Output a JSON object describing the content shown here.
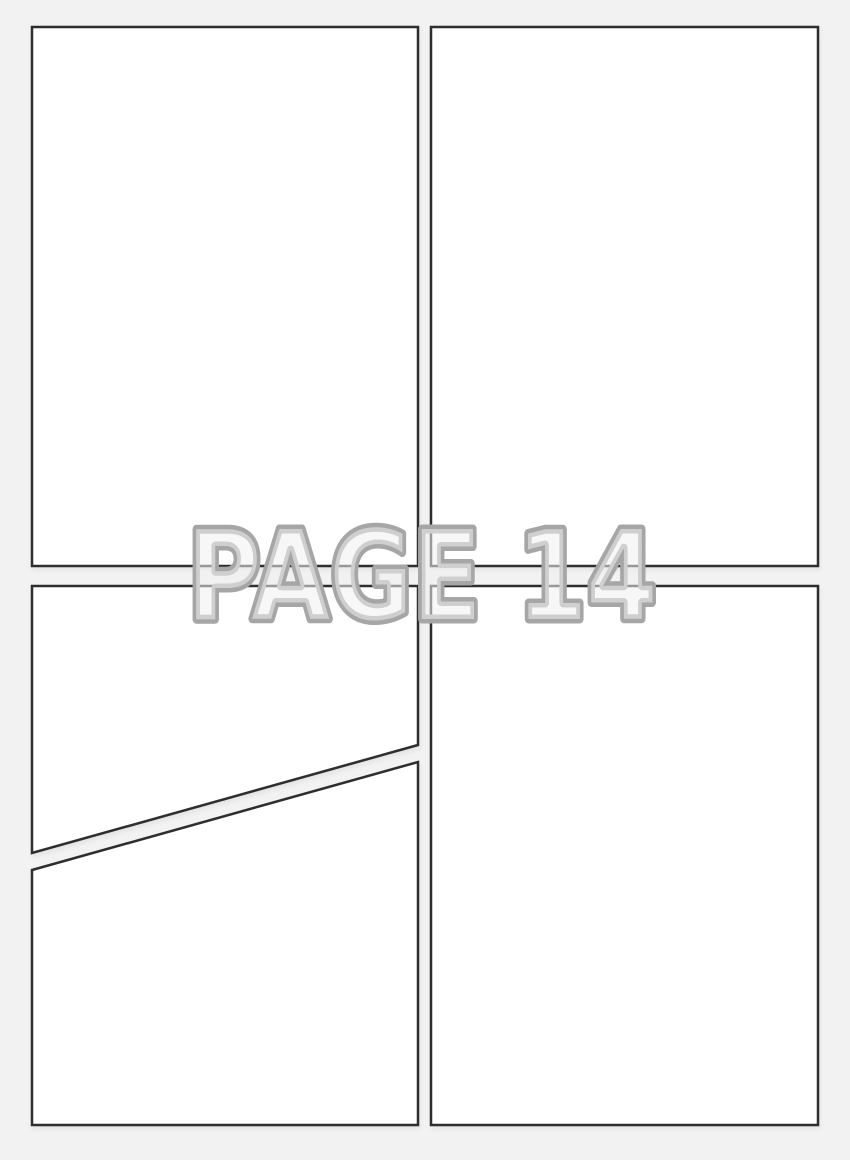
{
  "page": {
    "watermark_text": "PAGE 14",
    "page_number": "14",
    "kind": "blank-comic-page-template"
  },
  "panels": [
    {
      "name": "panel-top-left",
      "position": "top-left",
      "shape": "rectangle"
    },
    {
      "name": "panel-top-right",
      "position": "top-right",
      "shape": "rectangle"
    },
    {
      "name": "panel-middle-left",
      "position": "middle-left",
      "shape": "trapezoid-diagonal-bottom"
    },
    {
      "name": "panel-bottom-left",
      "position": "bottom-left",
      "shape": "trapezoid-diagonal-top"
    },
    {
      "name": "panel-bottom-right",
      "position": "bottom-right",
      "shape": "rectangle"
    }
  ],
  "colors": {
    "background": "#f2f2f3",
    "panel_fill": "#ffffff",
    "panel_border": "#2f2f2f",
    "watermark_fill": "#f0f0f1",
    "watermark_stroke": "#a6a6a6"
  }
}
